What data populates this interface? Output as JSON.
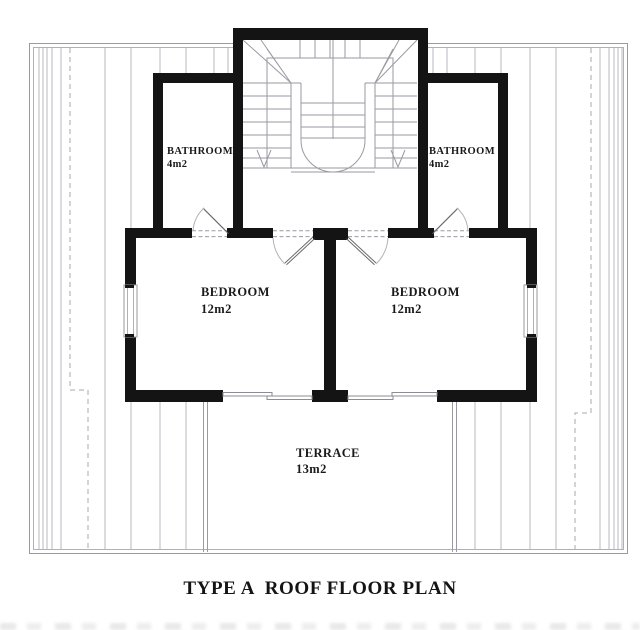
{
  "plan": {
    "title": "TYPE A  ROOF FLOOR PLAN",
    "rooms": {
      "bathroom_left": {
        "name": "BATHROOM",
        "area": "4m2"
      },
      "bathroom_right": {
        "name": "BATHROOM",
        "area": "4m2"
      },
      "bedroom_left": {
        "name": "BEDROOM",
        "area": "12m2"
      },
      "bedroom_right": {
        "name": "BEDROOM",
        "area": "12m2"
      },
      "terrace": {
        "name": "TERRACE",
        "area": "13m2"
      }
    },
    "colors": {
      "wall": "#141414",
      "thin_line": "#9a9aa2",
      "hatch_line": "#b9b9c1",
      "text": "#1a1a1a"
    }
  }
}
